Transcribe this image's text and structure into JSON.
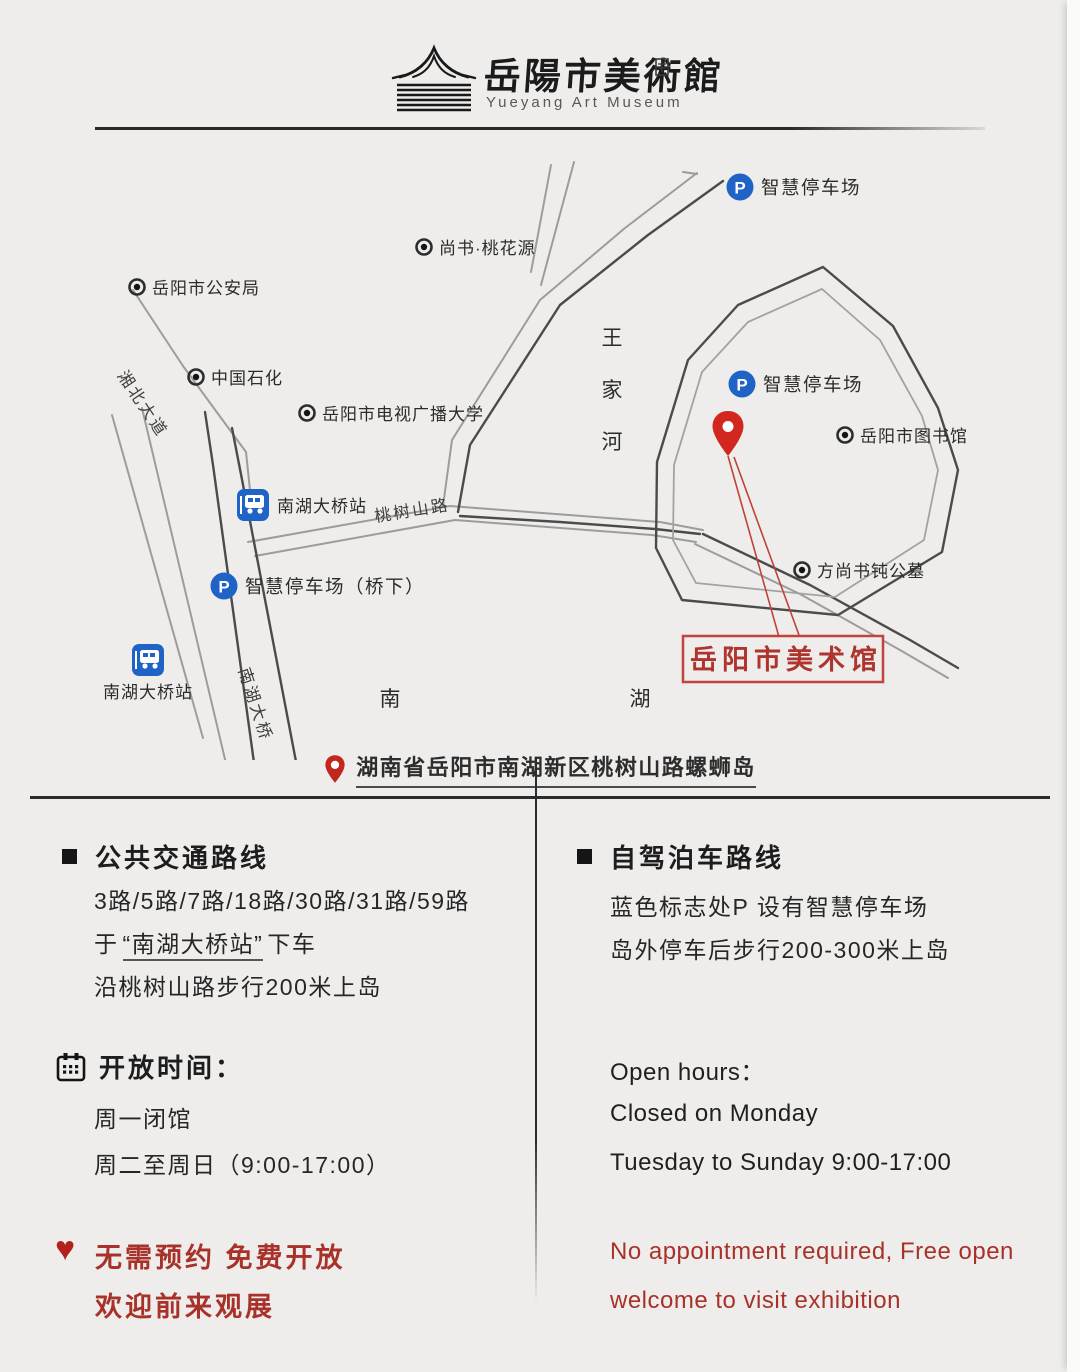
{
  "page": {
    "background": "#eeedeb"
  },
  "colors": {
    "icon_blue": "#2063c6",
    "red_pin": "#d2271e",
    "red_text": "#a8322a",
    "museum_box_red": "#c0443c",
    "dark_text": "#262626"
  },
  "logo": {
    "title_cn": "岳陽市美術館",
    "title_en": "Yueyang Art Museum"
  },
  "map": {
    "pois": [
      {
        "label": "尚书·桃花源",
        "x": 424,
        "y": 247
      },
      {
        "label": "岳阳市公安局",
        "x": 137,
        "y": 287
      },
      {
        "label": "中国石化",
        "x": 196,
        "y": 377
      },
      {
        "label": "岳阳市电视广播大学",
        "x": 307,
        "y": 413
      },
      {
        "label": "岳阳市图书馆",
        "x": 845,
        "y": 435
      },
      {
        "label": "方尚书钝公墓",
        "x": 802,
        "y": 570
      }
    ],
    "parking": [
      {
        "label": "智慧停车场",
        "x": 740,
        "y": 187
      },
      {
        "label": "智慧停车场",
        "x": 742,
        "y": 384
      },
      {
        "label": "智慧停车场（桥下）",
        "x": 224,
        "y": 586
      }
    ],
    "bus_stops": [
      {
        "label": "南湖大桥站",
        "x": 253,
        "y": 505,
        "label_pos": "right"
      },
      {
        "label": "南湖大桥站",
        "x": 148,
        "y": 660,
        "label_pos": "below"
      }
    ],
    "road_labels": [
      {
        "text": "桃树山路",
        "x": 413,
        "y": 516,
        "rotate": -9
      },
      {
        "text": "南湖大桥",
        "x": 250,
        "y": 706,
        "rotate": 72
      },
      {
        "text": "湘北大道",
        "x": 138,
        "y": 407,
        "rotate": 56
      }
    ],
    "area_labels": [
      {
        "text": "王家河",
        "x": 612,
        "y": 345,
        "vertical": true,
        "spacing": 52
      },
      {
        "text": "南",
        "x": 390,
        "y": 706
      },
      {
        "text": "湖",
        "x": 640,
        "y": 706
      }
    ],
    "museum": {
      "label": "岳阳市美术馆"
    }
  },
  "address": {
    "text": "湖南省岳阳市南湖新区桃树山路螺蛳岛"
  },
  "columns": {
    "left": {
      "transit": {
        "title": "公共交通路线",
        "routes": "3路/5路/7路/18路/30路/31路/59路",
        "board_prefix": "于",
        "board_station": "“南湖大桥站”",
        "board_suffix": "下车",
        "walk": "沿桃树山路步行200米上岛"
      },
      "hours": {
        "title": "开放时间：",
        "lines": [
          "周一闭馆",
          "周二至周日（9:00-17:00）"
        ]
      },
      "notice": {
        "lines": [
          "无需预约  免费开放",
          "欢迎前来观展"
        ]
      }
    },
    "right": {
      "drive": {
        "title": "自驾泊车路线",
        "lines": [
          "蓝色标志处P 设有智慧停车场",
          "岛外停车后步行200-300米上岛"
        ]
      },
      "hours": {
        "title": "Open hours：",
        "lines": [
          "Closed on Monday",
          "Tuesday to Sunday 9:00-17:00"
        ]
      },
      "notice": {
        "lines": [
          "No appointment required, Free open",
          "welcome to visit exhibition"
        ]
      }
    }
  }
}
